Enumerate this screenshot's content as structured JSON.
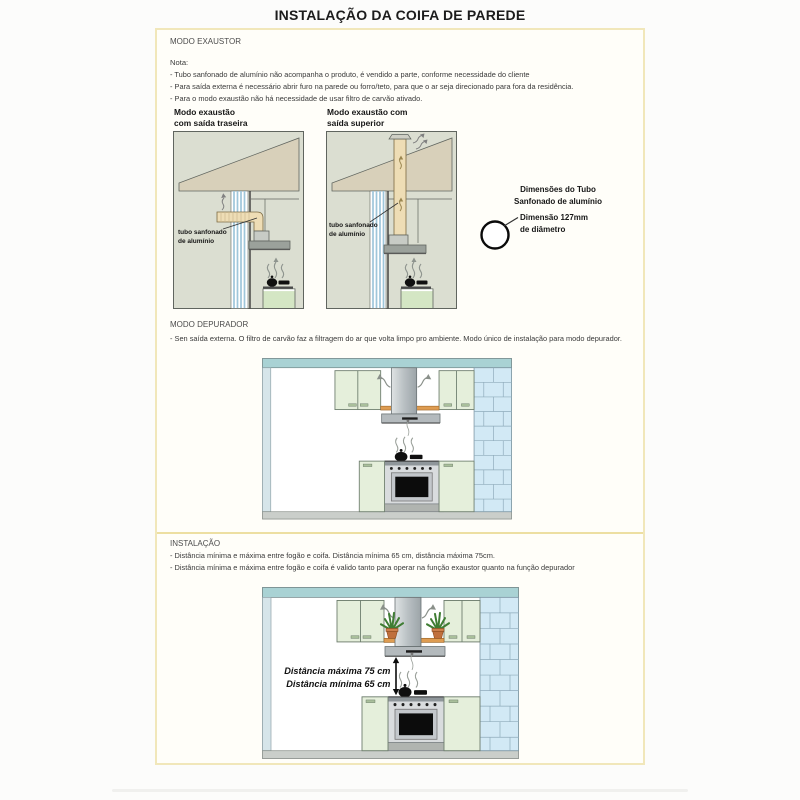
{
  "page": {
    "title": "INSTALAÇÃO DA COIFA DE PAREDE"
  },
  "exaustor": {
    "heading": "MODO EXAUSTOR",
    "nota": "Nota:",
    "bullets": [
      "- Tubo sanfonado de alumínio não acompanha o produto, é vendido a parte, conforme necessidade do cliente",
      "- Para saída externa é necessário abrir furo na parede ou forro/teto, para que o ar seja direcionado para fora da residência.",
      "- Para o modo exaustão não há necessidade de usar filtro de carvão ativado."
    ],
    "diagram_traseira": {
      "title1": "Modo exaustão",
      "title2": "com saída traseira",
      "tube1": "tubo sanfonado",
      "tube2": "de alumínio"
    },
    "diagram_superior": {
      "title1": "Modo exaustão com",
      "title2": "saída superior",
      "tube1": "tubo sanfonado",
      "tube2": "de alumínio"
    },
    "tubo_dim": {
      "h1": "Dimensões do Tubo",
      "h2": "Sanfonado de alumínio",
      "l1": "Dimensão 127mm",
      "l2": "de diâmetro"
    }
  },
  "depurador": {
    "heading": "MODO DEPURADOR",
    "bullet": "- Sen saída externa. O filtro de carvão faz a filtragem do ar que volta limpo pro ambiente. Modo único de instalação para modo depurador."
  },
  "instalacao": {
    "heading": "INSTALAÇÃO",
    "bullets": [
      "- Distância mínima e máxima entre fogão e coifa. Distância mínima 65 cm, distância máxima 75cm.",
      "- Distância mínima e máxima entre fogão e coifa é valido tanto para operar na função exaustor quanto na função depurador"
    ],
    "distance_max": "Distância máxima 75 cm",
    "distance_min": "Distância mínima 65 cm"
  },
  "colors": {
    "frame_cream": "#f1e7ba",
    "divider_yellow": "#eddfa2",
    "diagram_background": "#dbded1",
    "roof_beige": "#d8d0ba",
    "duct_tan": "#eeddb5",
    "wall_stripe_blue": "#9fc6da",
    "cabinet_green": "#e5efdb",
    "counter_green": "#d4e6c4",
    "brick_blue": "#d2e9f5",
    "ceiling_teal": "#a9d2d4",
    "shelf_orange": "#de9c51",
    "hood_gray": "#b4babd"
  }
}
